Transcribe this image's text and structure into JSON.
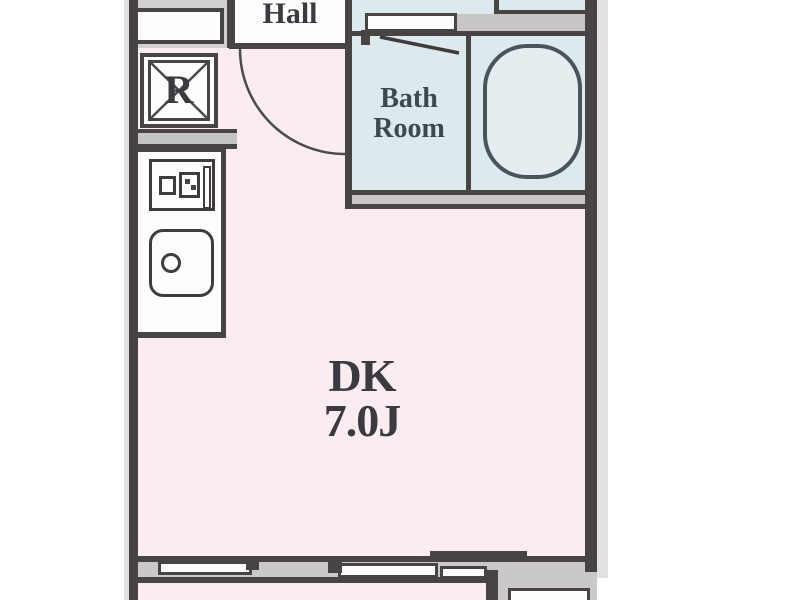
{
  "plan": {
    "type": "apartment-floorplan",
    "rooms": {
      "hall": {
        "label": "Hall"
      },
      "bathroom": {
        "label_line1": "Bath",
        "label_line2": "Room"
      },
      "dining_kitchen": {
        "label": "DK",
        "area": "7.0J"
      },
      "refrigerator": {
        "label": "R"
      }
    },
    "colors": {
      "floor_pink": "#faecf1",
      "floor_blue": "#dceaed",
      "bathtub_fill": "#e4eef1",
      "wall_dark": "#474443",
      "wall_gray": "#c8c5c5",
      "outer_edge_gray": "#e2e2e2",
      "fixture_white": "#fdfdfd",
      "text": "#3a3a40"
    }
  }
}
